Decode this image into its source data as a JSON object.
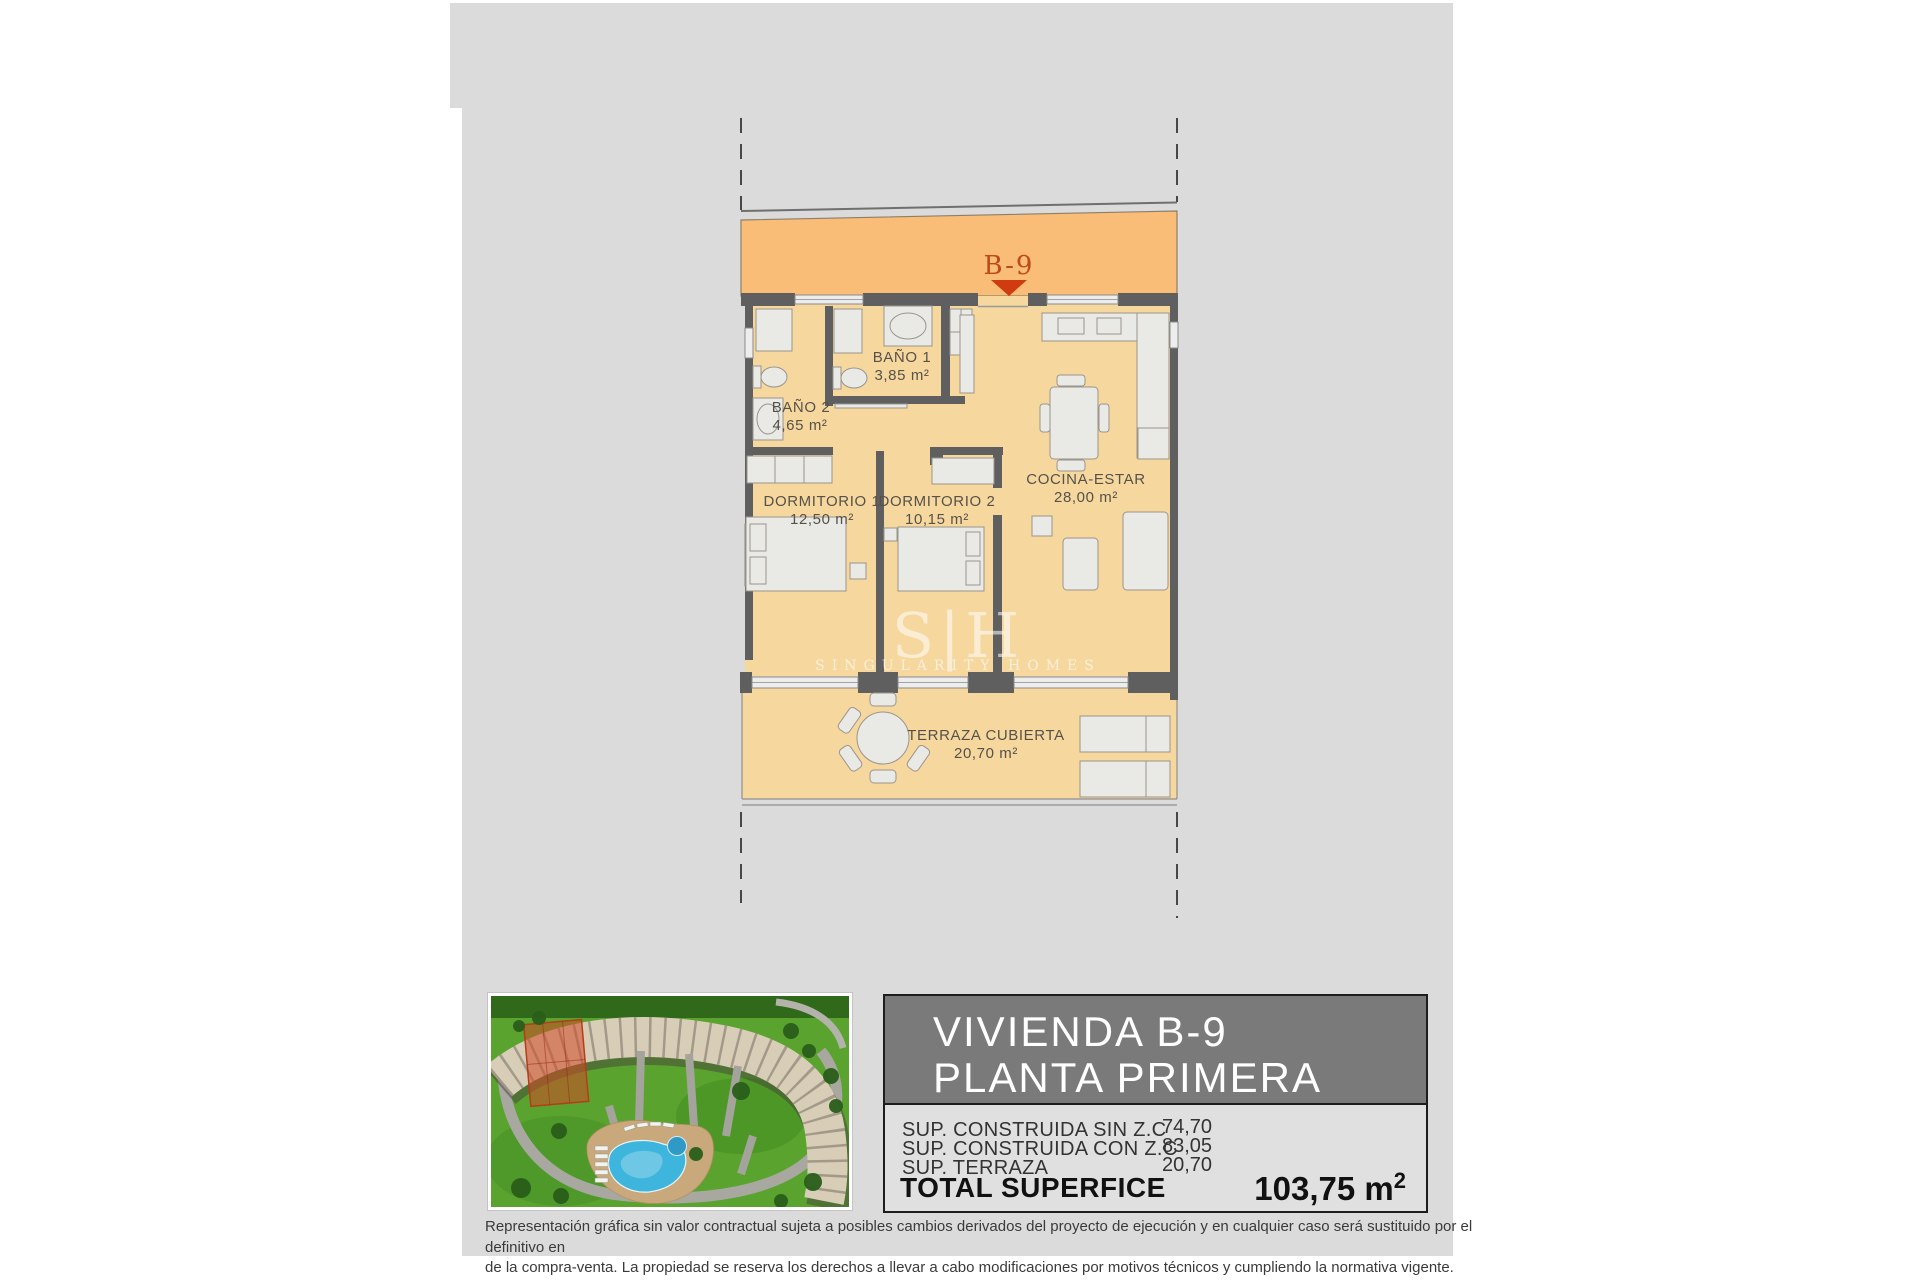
{
  "colors": {
    "page_background": "#ffffff",
    "canvas_gray": "#dbdbdb",
    "band_orange": "#fabd78",
    "room_cream": "#f6d79e",
    "wall_gray": "#5f5f5f",
    "marker_red": "#bc4a1c",
    "header_gray": "#7a7a7a",
    "pool_blue": "#3db5dd",
    "lawn_green": "#5aa32f",
    "highlight_red": "#c8442a"
  },
  "plan": {
    "marker": {
      "label": "B-9"
    },
    "rooms": {
      "bano1": {
        "name": "BAÑO 1",
        "area": "3,85 m²"
      },
      "bano2": {
        "name": "BAÑO 2",
        "area": "4,65 m²"
      },
      "dorm1": {
        "name": "DORMITORIO 1",
        "area": "12,50 m²"
      },
      "dorm2": {
        "name": "DORMITORIO 2",
        "area": "10,15 m²"
      },
      "cocina": {
        "name": "COCINA-ESTAR",
        "area": "28,00 m²"
      },
      "terraza": {
        "name": "TERRAZA CUBIERTA",
        "area": "20,70 m²"
      }
    },
    "watermark": {
      "initials": "S|H",
      "brand": "SINGULARITY HOMES"
    }
  },
  "info_panel": {
    "title_line1": "VIVIENDA B-9",
    "title_line2": "PLANTA PRIMERA",
    "rows": [
      {
        "label": "SUP. CONSTRUIDA SIN Z.C",
        "value": "74,70"
      },
      {
        "label": "SUP. CONSTRUIDA CON Z.C",
        "value": "83,05"
      },
      {
        "label": "SUP. TERRAZA",
        "value": "20,70"
      }
    ],
    "total_label": "TOTAL SUPERFICE",
    "total_value": "103,75 m",
    "total_sup": "2"
  },
  "disclaimer": {
    "line1": "Representación gráfica sin valor contractual sujeta a posibles cambios derivados del proyecto de ejecución y en cualquier caso será sustituido por el definitivo en",
    "line2": "de la compra-venta. La propiedad se reserva los derechos a llevar a cabo modificaciones por motivos técnicos y cumpliendo la normativa vigente."
  }
}
